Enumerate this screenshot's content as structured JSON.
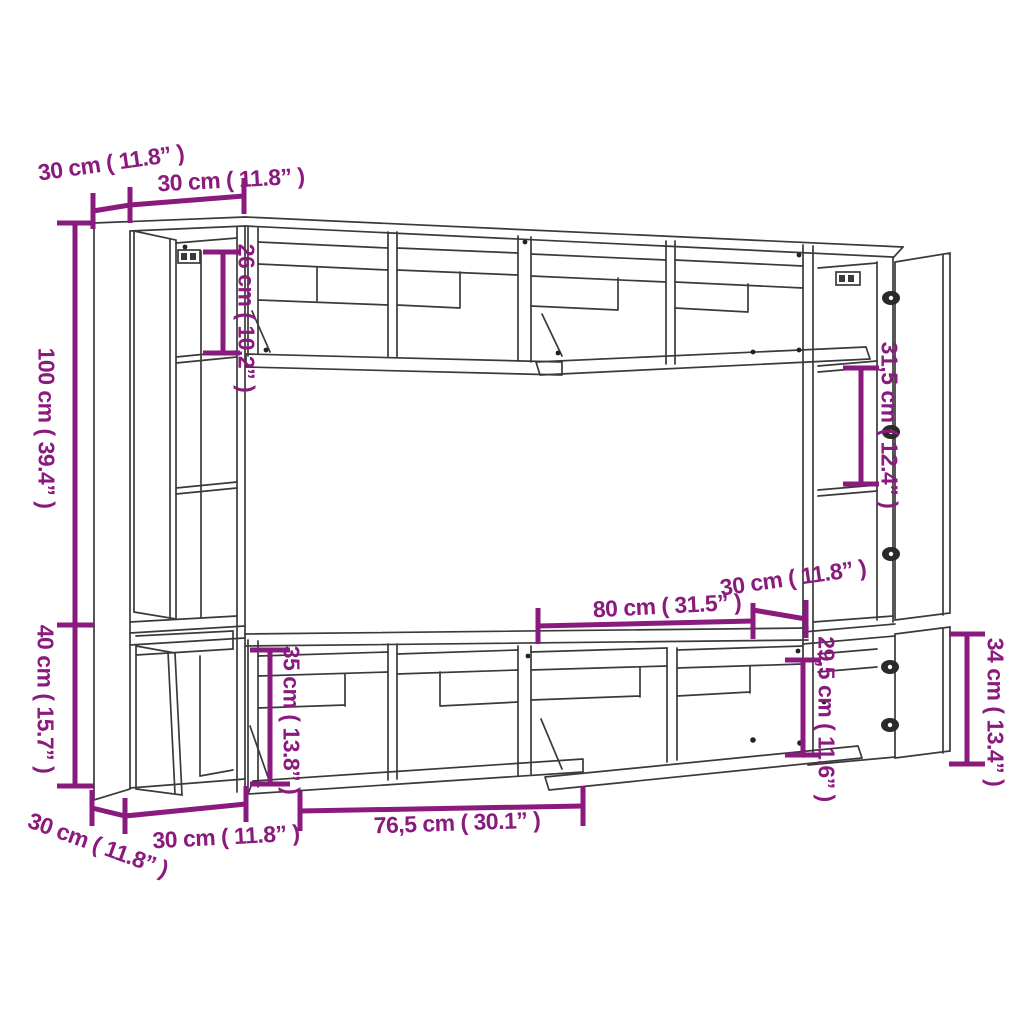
{
  "page": {
    "background": "#ffffff"
  },
  "drawing": {
    "description": "TV wall unit cabinet set - technical dimension line drawing",
    "colors": {
      "dimension_accent": "#8a1a7d",
      "furniture_line": "#3a3a3a",
      "background": "#ffffff"
    },
    "labels": {
      "top_side_depth": "30 cm ( 11.8” )",
      "top_left_width": "30 cm ( 11.8” )",
      "upper_inner_height": "26 cm ( 10.2” )",
      "left_tall_height": "100 cm ( 39.4” )",
      "left_lower_height": "40 cm ( 15.7” )",
      "bottom_side_depth": "30 cm ( 11.8” )",
      "bottom_left_width": "30 cm ( 11.8” )",
      "lower_inner_height": "35 cm ( 13.8” )",
      "flap_door_width": "76,5 cm ( 30.1” )",
      "wall_cabinet_width": "80 cm ( 31.5” )",
      "right_side_depth": "30 cm ( 11.8” )",
      "right_lower_inner_height": "29,5 cm ( 11.6” )",
      "right_shelf_spacing": "31,5 cm ( 12.4” )",
      "right_lower_height": "34 cm ( 13.4” )"
    }
  }
}
